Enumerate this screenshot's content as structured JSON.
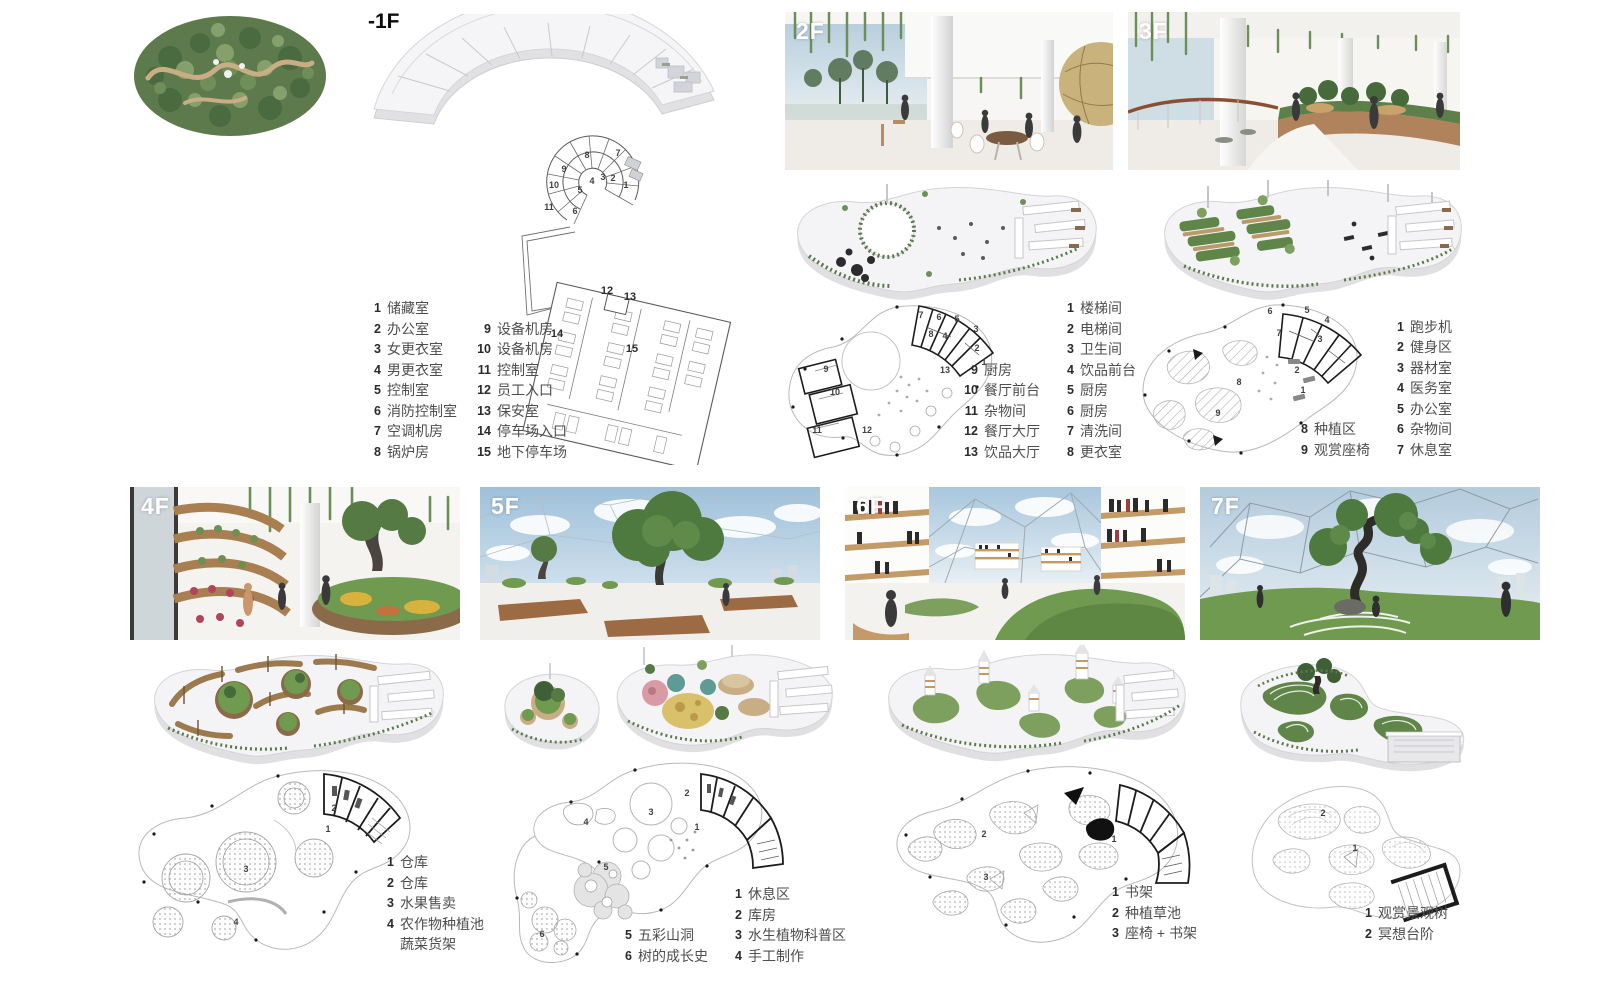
{
  "floors": {
    "b1": {
      "label": "-1F",
      "legend_col1": [
        {
          "n": "1",
          "t": "储藏室"
        },
        {
          "n": "2",
          "t": "办公室"
        },
        {
          "n": "3",
          "t": "女更衣室"
        },
        {
          "n": "4",
          "t": "男更衣室"
        },
        {
          "n": "5",
          "t": "控制室"
        },
        {
          "n": "6",
          "t": "消防控制室"
        },
        {
          "n": "7",
          "t": "空调机房"
        },
        {
          "n": "8",
          "t": "锅炉房"
        }
      ],
      "legend_col2": [
        {
          "n": "9",
          "t": "设备机房"
        },
        {
          "n": "10",
          "t": "设备机房"
        },
        {
          "n": "11",
          "t": "控制室"
        },
        {
          "n": "12",
          "t": "员工入口"
        },
        {
          "n": "13",
          "t": "保安室"
        },
        {
          "n": "14",
          "t": "停车场入口"
        },
        {
          "n": "15",
          "t": "地下停车场"
        }
      ],
      "plan_markers": [
        {
          "n": "7",
          "x": 138,
          "y": 21
        },
        {
          "n": "8",
          "x": 107,
          "y": 23
        },
        {
          "n": "9",
          "x": 84,
          "y": 37
        },
        {
          "n": "10",
          "x": 74,
          "y": 53
        },
        {
          "n": "11",
          "x": 69,
          "y": 75
        },
        {
          "n": "1",
          "x": 146,
          "y": 53
        },
        {
          "n": "2",
          "x": 133,
          "y": 46
        },
        {
          "n": "3",
          "x": 123,
          "y": 45
        },
        {
          "n": "4",
          "x": 112,
          "y": 49
        },
        {
          "n": "5",
          "x": 100,
          "y": 58
        },
        {
          "n": "6",
          "x": 95,
          "y": 79
        }
      ],
      "park_markers": [
        {
          "n": "12",
          "x": 127,
          "y": 159
        },
        {
          "n": "13",
          "x": 150,
          "y": 165
        },
        {
          "n": "14",
          "x": 77,
          "y": 202
        },
        {
          "n": "15",
          "x": 152,
          "y": 217
        }
      ]
    },
    "f2": {
      "label": "2F",
      "legend_col1": [
        {
          "n": "9",
          "t": "厨房"
        },
        {
          "n": "10",
          "t": "餐厅前台"
        },
        {
          "n": "11",
          "t": "杂物间"
        },
        {
          "n": "12",
          "t": "餐厅大厅"
        },
        {
          "n": "13",
          "t": "饮品大厅"
        }
      ],
      "legend_col2": [
        {
          "n": "1",
          "t": "楼梯间"
        },
        {
          "n": "2",
          "t": "电梯间"
        },
        {
          "n": "3",
          "t": "卫生间"
        },
        {
          "n": "4",
          "t": "饮品前台"
        },
        {
          "n": "5",
          "t": "厨房"
        },
        {
          "n": "6",
          "t": "厨房"
        },
        {
          "n": "7",
          "t": "清洗间"
        },
        {
          "n": "8",
          "t": "更衣室"
        }
      ],
      "plan_markers": [
        {
          "n": "7",
          "x": 142,
          "y": 19
        },
        {
          "n": "6",
          "x": 160,
          "y": 21
        },
        {
          "n": "5",
          "x": 178,
          "y": 23
        },
        {
          "n": "8",
          "x": 152,
          "y": 38
        },
        {
          "n": "4",
          "x": 166,
          "y": 40
        },
        {
          "n": "3",
          "x": 197,
          "y": 33
        },
        {
          "n": "2",
          "x": 198,
          "y": 52
        },
        {
          "n": "1",
          "x": 205,
          "y": 66
        },
        {
          "n": "9",
          "x": 47,
          "y": 73
        },
        {
          "n": "10",
          "x": 56,
          "y": 96
        },
        {
          "n": "11",
          "x": 38,
          "y": 134
        },
        {
          "n": "12",
          "x": 88,
          "y": 134
        },
        {
          "n": "13",
          "x": 166,
          "y": 74
        }
      ]
    },
    "f3": {
      "label": "3F",
      "legend_col1": [
        {
          "n": "8",
          "t": "种植区"
        },
        {
          "n": "9",
          "t": "观赏座椅"
        }
      ],
      "legend_col2": [
        {
          "n": "1",
          "t": "跑步机"
        },
        {
          "n": "2",
          "t": "健身区"
        },
        {
          "n": "3",
          "t": "器材室"
        },
        {
          "n": "4",
          "t": "医务室"
        },
        {
          "n": "5",
          "t": "办公室"
        },
        {
          "n": "6",
          "t": "杂物间"
        },
        {
          "n": "7",
          "t": "休息室"
        }
      ],
      "plan_markers": [
        {
          "n": "6",
          "x": 137,
          "y": 15
        },
        {
          "n": "5",
          "x": 174,
          "y": 14
        },
        {
          "n": "4",
          "x": 194,
          "y": 24
        },
        {
          "n": "7",
          "x": 146,
          "y": 37
        },
        {
          "n": "3",
          "x": 187,
          "y": 43
        },
        {
          "n": "2",
          "x": 164,
          "y": 74
        },
        {
          "n": "1",
          "x": 170,
          "y": 94
        },
        {
          "n": "8",
          "x": 106,
          "y": 86
        },
        {
          "n": "9",
          "x": 85,
          "y": 117
        }
      ]
    },
    "f4": {
      "label": "4F",
      "legend_col1": [
        {
          "n": "1",
          "t": "仓库"
        },
        {
          "n": "2",
          "t": "仓库"
        },
        {
          "n": "3",
          "t": "水果售卖"
        },
        {
          "n": "4",
          "t": "农作物种植池\n蔬菜货架"
        }
      ],
      "plan_markers": [
        {
          "n": "2",
          "x": 206,
          "y": 49
        },
        {
          "n": "1",
          "x": 200,
          "y": 70
        },
        {
          "n": "3",
          "x": 118,
          "y": 110
        },
        {
          "n": "4",
          "x": 108,
          "y": 163
        }
      ]
    },
    "f5": {
      "label": "5F",
      "legend_col1": [
        {
          "n": "5",
          "t": "五彩山洞"
        },
        {
          "n": "6",
          "t": "树的成长史"
        }
      ],
      "legend_col2": [
        {
          "n": "1",
          "t": "休息区"
        },
        {
          "n": "2",
          "t": "库房"
        },
        {
          "n": "3",
          "t": "水生植物科普区"
        },
        {
          "n": "4",
          "t": "手工制作"
        }
      ],
      "plan_markers": [
        {
          "n": "3",
          "x": 156,
          "y": 63
        },
        {
          "n": "2",
          "x": 192,
          "y": 44
        },
        {
          "n": "1",
          "x": 202,
          "y": 78
        },
        {
          "n": "4",
          "x": 91,
          "y": 73
        },
        {
          "n": "5",
          "x": 111,
          "y": 118
        },
        {
          "n": "6",
          "x": 47,
          "y": 185
        }
      ]
    },
    "f6": {
      "label": "6F",
      "legend_col1": [
        {
          "n": "1",
          "t": "书架"
        },
        {
          "n": "2",
          "t": "种植草池"
        },
        {
          "n": "3",
          "t": "座椅 + 书架"
        }
      ],
      "plan_markers": [
        {
          "n": "2",
          "x": 106,
          "y": 82
        },
        {
          "n": "3",
          "x": 108,
          "y": 125
        },
        {
          "n": "1",
          "x": 236,
          "y": 87
        }
      ]
    },
    "f7": {
      "label": "7F",
      "legend_col1": [
        {
          "n": "1",
          "t": "观赏景观树"
        },
        {
          "n": "2",
          "t": "冥想台阶"
        }
      ],
      "plan_markers": [
        {
          "n": "2",
          "x": 85,
          "y": 41
        },
        {
          "n": "1",
          "x": 117,
          "y": 76
        }
      ]
    }
  }
}
